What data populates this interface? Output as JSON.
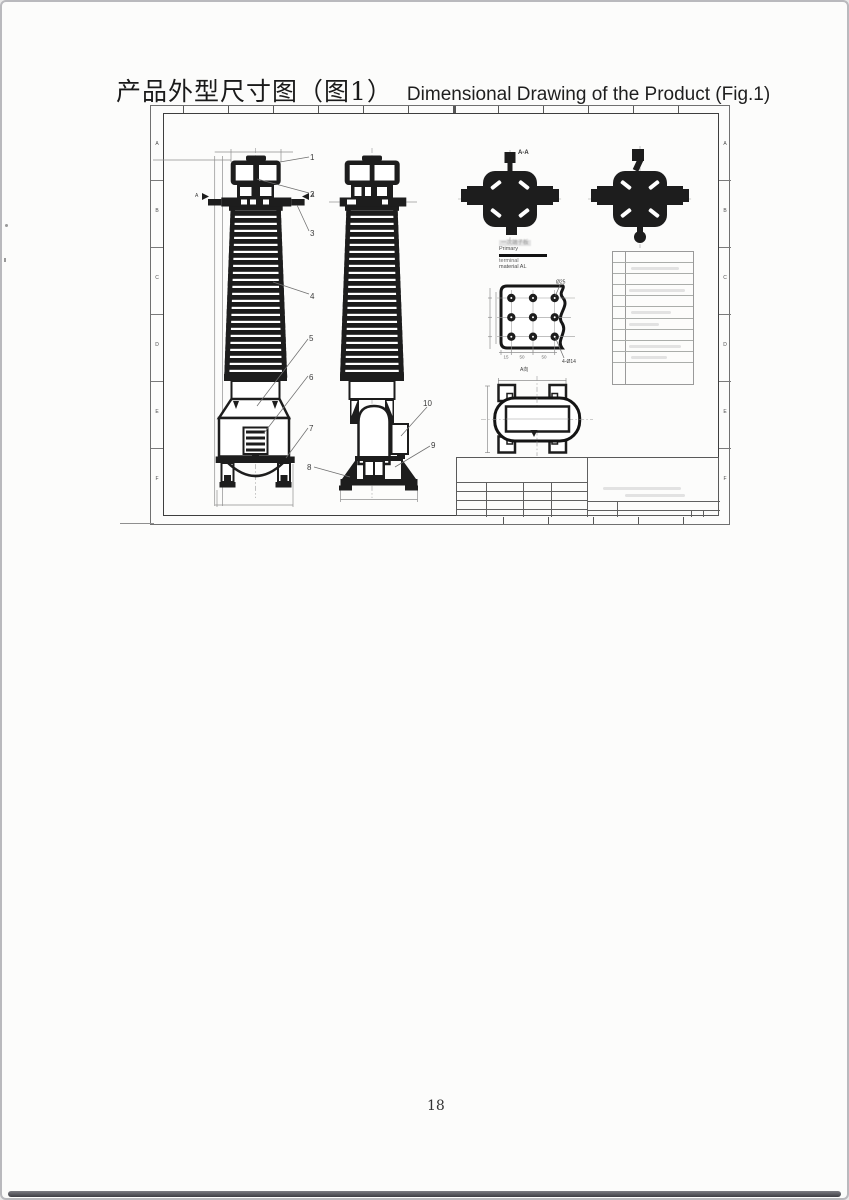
{
  "page": {
    "title_cn": "产品外型尺寸图（图1）",
    "title_en": "Dimensional Drawing of the Product (Fig.1)",
    "page_number": "18"
  },
  "sheet": {
    "zones": [
      "A",
      "B",
      "C",
      "D",
      "E",
      "F"
    ]
  },
  "drawing": {
    "callouts": [
      "1",
      "2",
      "3",
      "4",
      "5",
      "6",
      "7",
      "8",
      "9",
      "10"
    ],
    "section_label": "A-A",
    "section_arrow": "A",
    "view_a_label": "A向",
    "note": {
      "cn": "一次端子板",
      "l1": "Primary",
      "l2": "terminal",
      "l3": "material AL"
    },
    "plate": {
      "hole_label": "Ø25",
      "corner_label": "4-Ø14",
      "d1": "15",
      "d2": "50",
      "d3": "50"
    }
  }
}
